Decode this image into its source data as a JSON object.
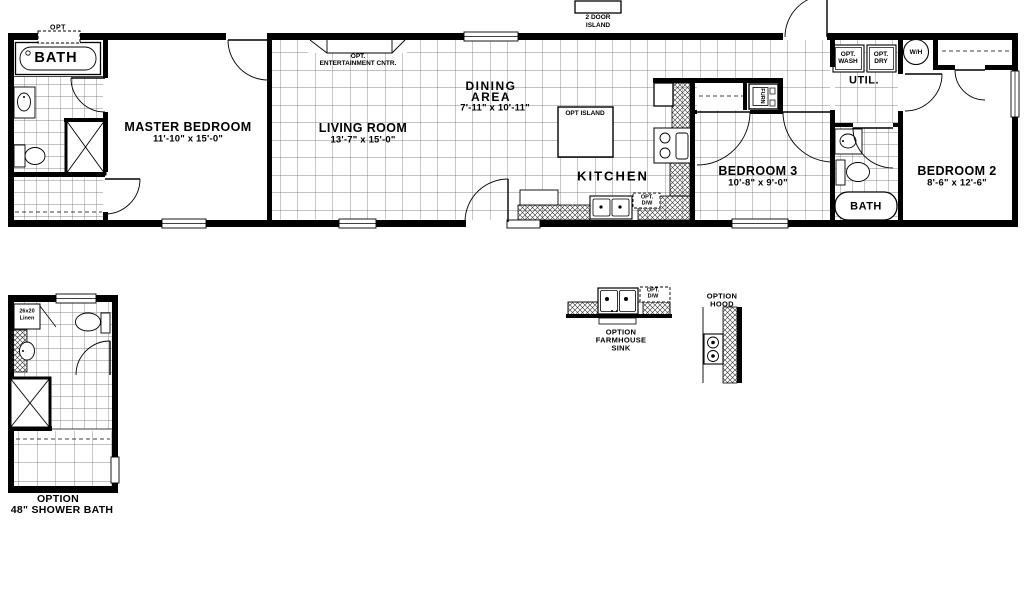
{
  "plan": {
    "master_bath": {
      "label": "BATH",
      "opt_window": "OPT"
    },
    "master_bedroom": {
      "name": "MASTER BEDROOM",
      "dims": "11'-10\" x  15'-0\""
    },
    "living_room": {
      "name": "LIVING ROOM",
      "dims": "13'-7\" x  15'-0\"",
      "ent_line1": "OPT.",
      "ent_line2": "ENTERTAINMENT CNTR."
    },
    "dining_area": {
      "name_line1": "DINING",
      "name_line2": "AREA",
      "dims": "7'-11\" x  10'-11\"",
      "island_ext_line1": "2 DOOR",
      "island_ext_line2": "ISLAND"
    },
    "kitchen": {
      "name": "KITCHEN",
      "opt_island": "OPT ISLAND",
      "opt_dw_line1": "OPT.",
      "opt_dw_line2": "D/W"
    },
    "hall": {
      "furnace": "FURN"
    },
    "utility": {
      "label": "UTIL.",
      "wash_line1": "OPT.",
      "wash_line2": "WASH",
      "dry_line1": "OPT.",
      "dry_line2": "DRY",
      "water_heater": "W/H"
    },
    "bedroom3": {
      "name": "BEDROOM 3",
      "dims": "10'-8\" x  9'-0\""
    },
    "bath2": {
      "label": "BATH"
    },
    "bedroom2": {
      "name": "BEDROOM 2",
      "dims": "8'-6\" x  12'-6\""
    }
  },
  "options": {
    "shower_bath": {
      "line1": "OPTION",
      "line2": "48\" SHOWER BATH",
      "linen_line1": "26x20",
      "linen_line2": "Linen"
    },
    "farmhouse_sink": {
      "line1": "OPTION",
      "line2": "FARMHOUSE",
      "line3": "SINK",
      "opt_dw_line1": "OPT.",
      "opt_dw_line2": "D/W"
    },
    "hood": {
      "line1": "OPTION",
      "line2": "HOOD"
    }
  },
  "colors": {
    "wall": "#000000",
    "grid_line": "#606060",
    "hatch": "#303030",
    "background": "#ffffff"
  }
}
